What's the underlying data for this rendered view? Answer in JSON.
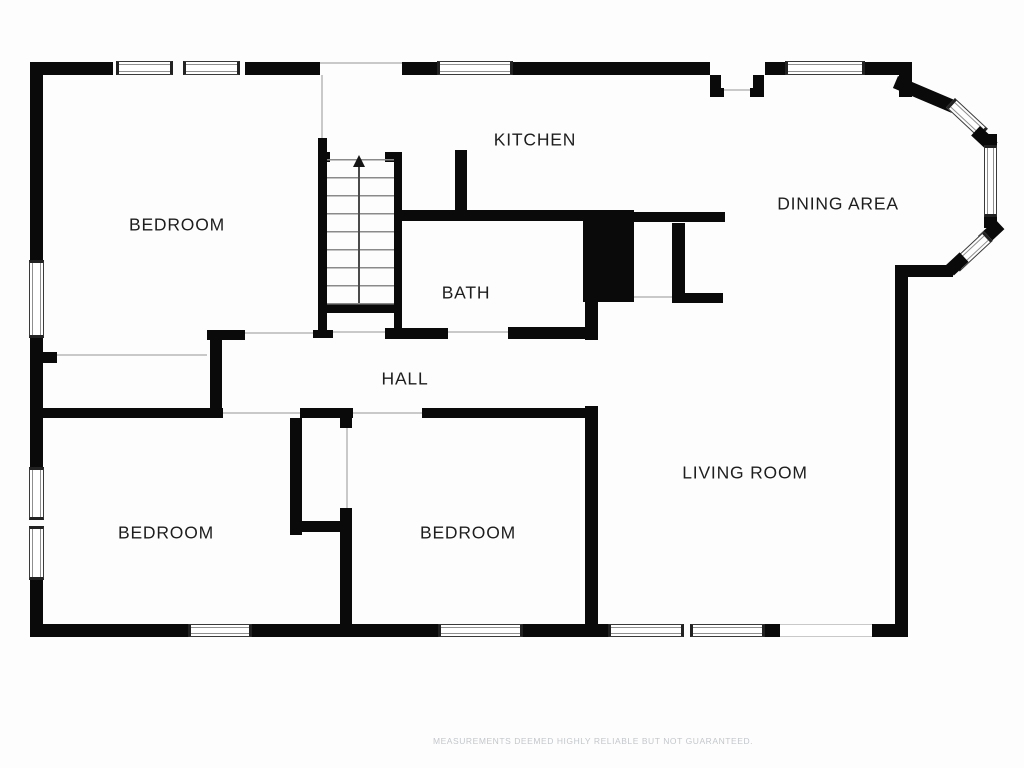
{
  "floorplan": {
    "rooms": [
      {
        "id": "bedroom-top-left",
        "label": "BEDROOM"
      },
      {
        "id": "kitchen",
        "label": "KITCHEN"
      },
      {
        "id": "dining-area",
        "label": "DINING AREA"
      },
      {
        "id": "bath",
        "label": "BATH"
      },
      {
        "id": "hall",
        "label": "HALL"
      },
      {
        "id": "living-room",
        "label": "LIVING ROOM"
      },
      {
        "id": "bedroom-bottom-left",
        "label": "BEDROOM"
      },
      {
        "id": "bedroom-bottom-middle",
        "label": "BEDROOM"
      }
    ],
    "stairs": {
      "direction": "up",
      "treads": 8
    },
    "disclaimer": "MEASUREMENTS DEEMED HIGHLY RELIABLE BUT NOT GUARANTEED.",
    "colors": {
      "wall": "#0a0a0a",
      "background": "#fdfdfd",
      "opening_line": "#c9c9c9",
      "label": "#1e1e1e",
      "disclaimer": "#c3c7cb",
      "window_frame": "#3a3a3a",
      "tread_line": "#8a8a8a"
    }
  }
}
